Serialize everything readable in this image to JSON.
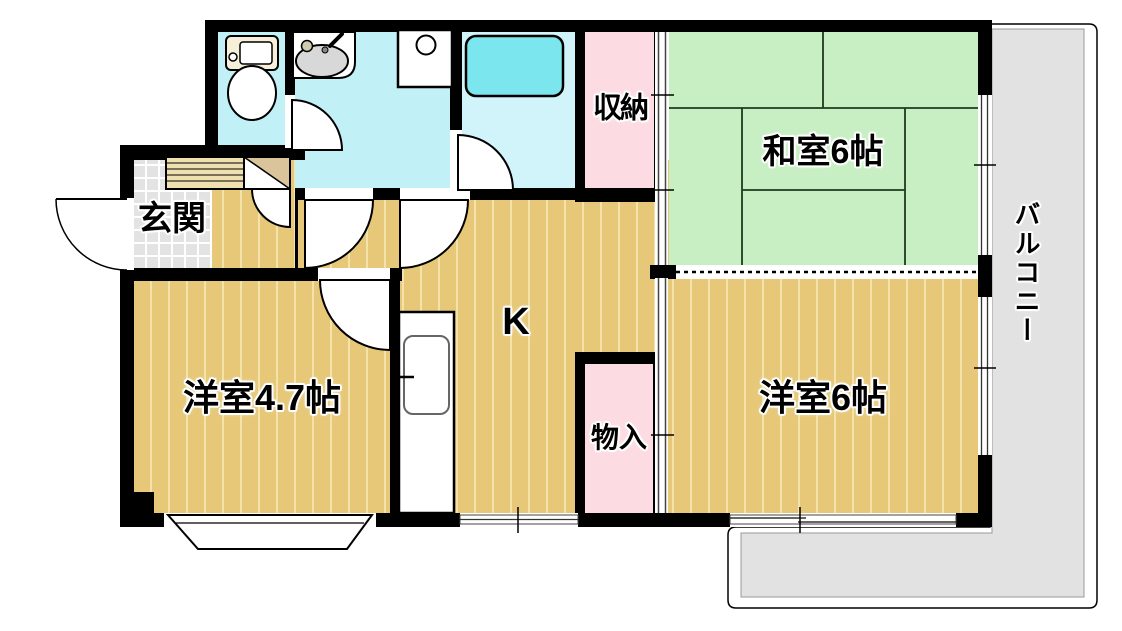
{
  "plan_type": "apartment-floorplan",
  "rooms": {
    "genkan": {
      "label": "玄関"
    },
    "storage": {
      "label": "収納"
    },
    "washitsu": {
      "label": "和室6帖"
    },
    "kitchen": {
      "label": "K"
    },
    "western_4_7": {
      "label": "洋室4.7帖"
    },
    "closet": {
      "label": "物入"
    },
    "western_6": {
      "label": "洋室6帖"
    },
    "balcony": {
      "label": "バルコニー"
    }
  },
  "colors": {
    "wall": "#000000",
    "wood_floor": "#e6c878",
    "wood_stripe": "#f3e3ab",
    "tatami_green": "#c7efc3",
    "water_cyan": "#c2f0f7",
    "bath_cyan": "#d0f4f9",
    "bathtub_cyan": "#7ce6ef",
    "closet_pink": "#fcdce2",
    "entry_tile_gray": "#e3e3e3",
    "balcony_gray": "#e2e2e2"
  },
  "fixtures": {
    "toilet": "toilet-icon",
    "washbasin": "washbasin-icon",
    "washing_machine": "washing-machine-icon",
    "bathtub": "bathtub-icon",
    "kitchen_sink": "kitchen-sink-icon",
    "shoe_cabinet": "shoe-cabinet-icon",
    "entry_cabinet": "entry-cabinet-icon",
    "bay_window": "bay-window-icon"
  }
}
